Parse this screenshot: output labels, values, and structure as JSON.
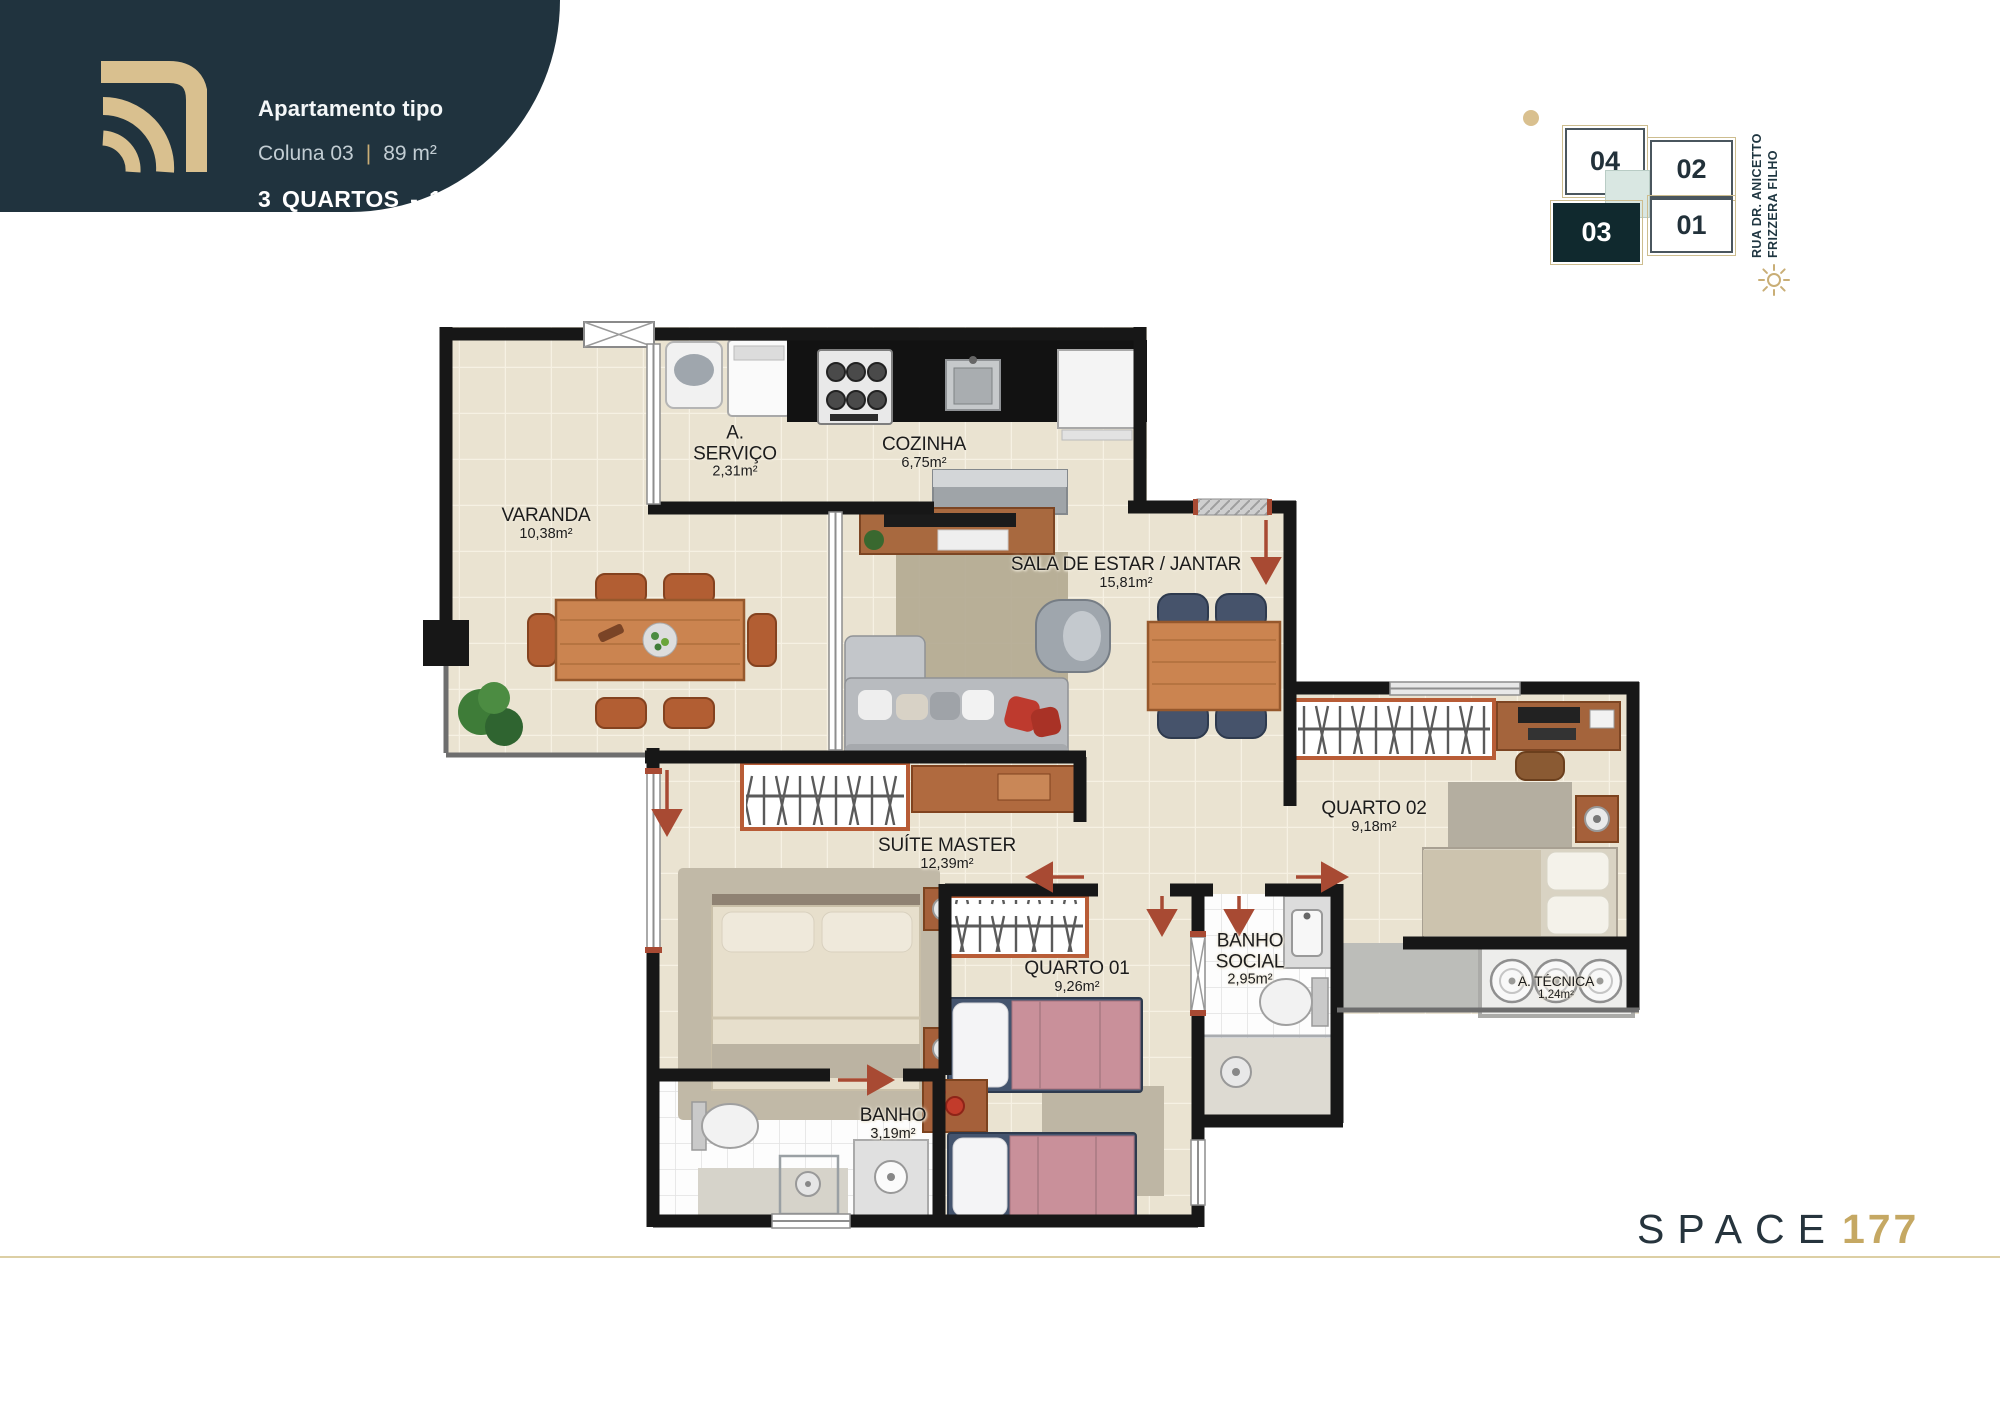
{
  "header": {
    "title": "Apartamento tipo",
    "subtitle": {
      "left": "Coluna 03",
      "separator": "|",
      "right": "89 m²"
    },
    "highlight": "3 QUARTOS - 1 SUÍTE"
  },
  "keyplan": {
    "street_line1": "RUA DR. ANICETTO",
    "street_line2": "FRIZZERA FILHO",
    "active_unit": "03",
    "units": [
      {
        "id": "04"
      },
      {
        "id": "02"
      },
      {
        "id": "03"
      },
      {
        "id": "01"
      }
    ]
  },
  "rooms": [
    {
      "name": "VARANDA",
      "area": "10,38m²"
    },
    {
      "name": "A. SERVIÇO",
      "area": "2,31m²"
    },
    {
      "name": "COZINHA",
      "area": "6,75m²"
    },
    {
      "name": "SALA DE ESTAR / JANTAR",
      "area": "15,81m²"
    },
    {
      "name": "SUÍTE MASTER",
      "area": "12,39m²"
    },
    {
      "name": "QUARTO 01",
      "area": "9,26m²"
    },
    {
      "name": "QUARTO 02",
      "area": "9,18m²"
    },
    {
      "name": "BANHO",
      "area": "3,19m²"
    },
    {
      "name": "BANHO SOCIAL",
      "area": "2,95m²"
    },
    {
      "name": "A. TÉCNICA",
      "area": "1,24m²"
    }
  ],
  "brand": {
    "name": "SPACE",
    "number": "177"
  },
  "colors": {
    "banner": "#20333E",
    "gold": "#D9C08F",
    "unit_active": "#10292E",
    "elevator_core": "#D9E7E2",
    "wall": "#171717",
    "floor": "#EAE3D1",
    "door_arrow": "#A84A33",
    "footer_rule": "#DCCFA4"
  }
}
